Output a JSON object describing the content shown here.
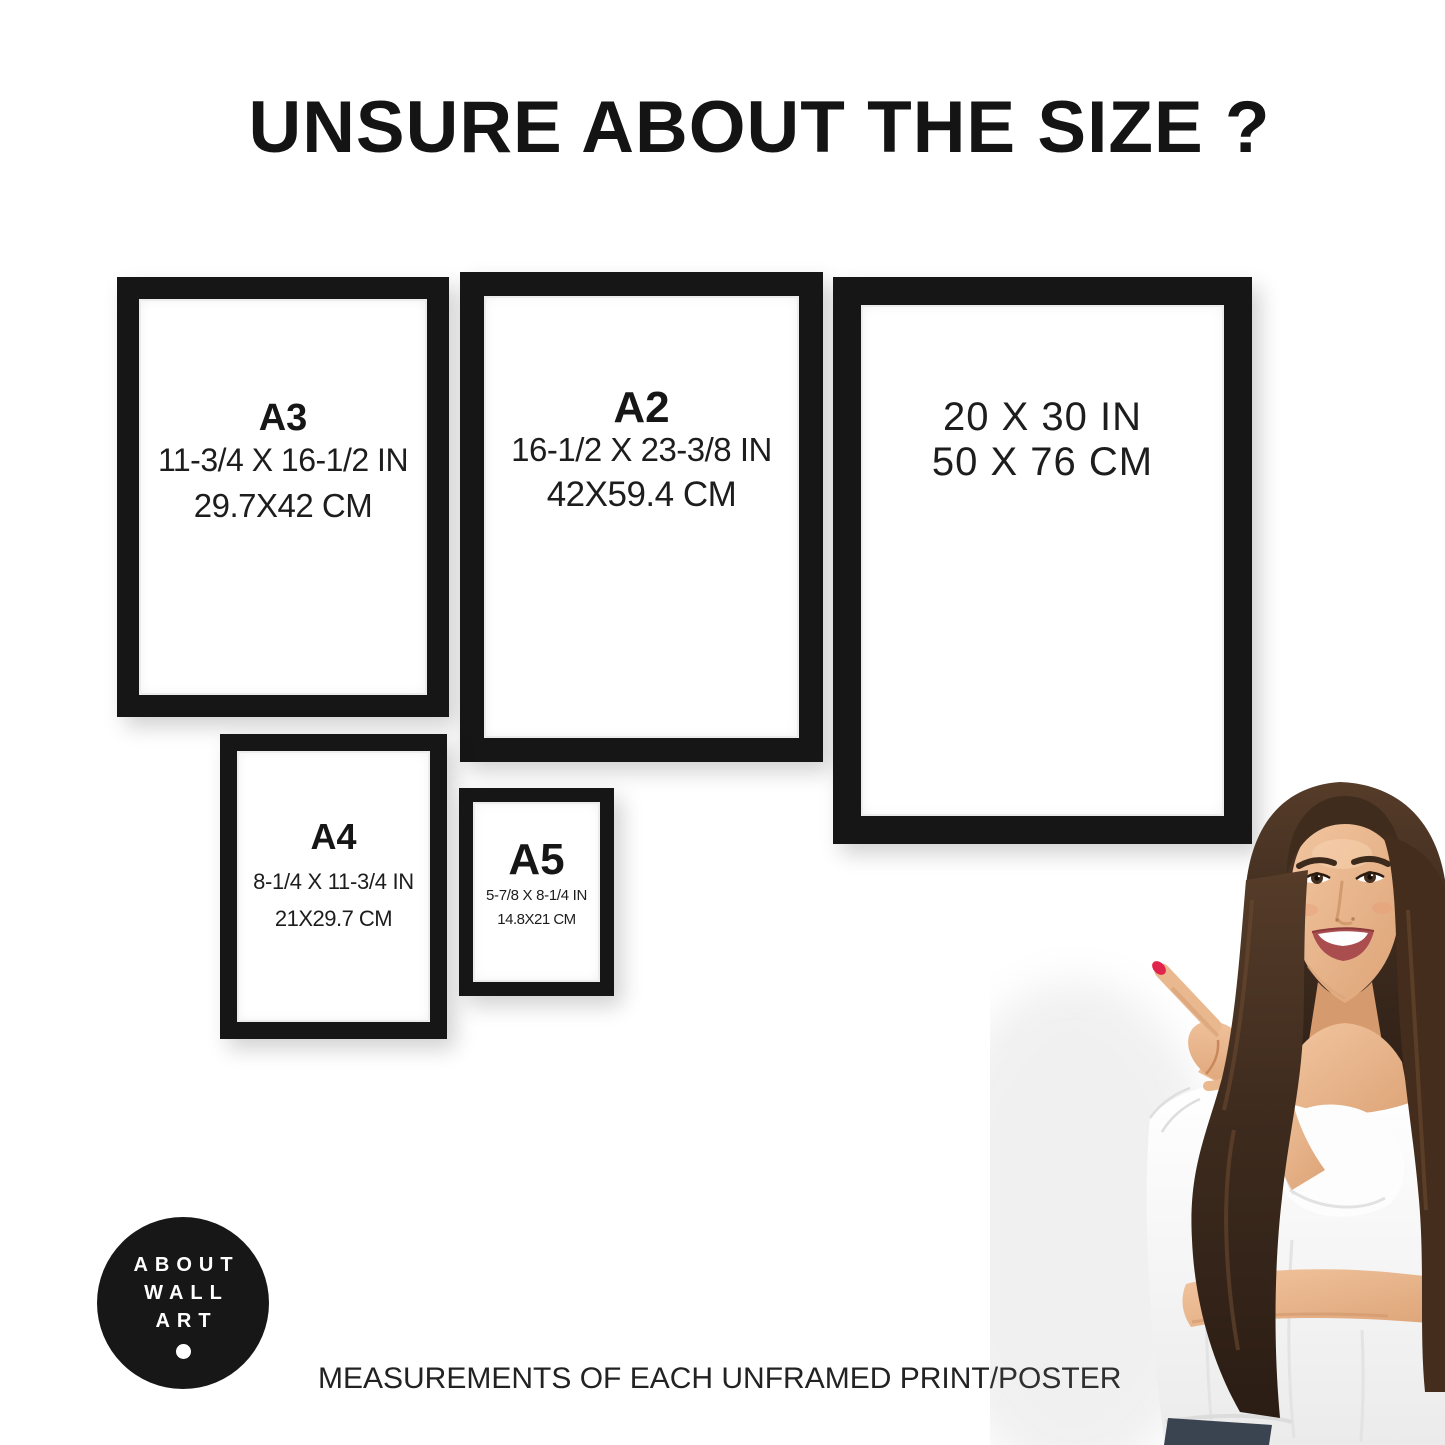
{
  "title": "UNSURE ABOUT THE SIZE ?",
  "caption": "MEASUREMENTS OF EACH UNFRAMED PRINT/POSTER",
  "frames": {
    "a3": {
      "label": "A3",
      "inches": "11-3/4 X 16-1/2 IN",
      "cm": "29.7X42 CM"
    },
    "a2": {
      "label": "A2",
      "inches": "16-1/2 X 23-3/8 IN",
      "cm": "42X59.4 CM"
    },
    "p2030": {
      "inches": "20 X 30 IN",
      "cm": "50 X 76 CM"
    },
    "a4": {
      "label": "A4",
      "inches": "8-1/4 X 11-3/4 IN",
      "cm": "21X29.7 CM"
    },
    "a5": {
      "label": "A5",
      "inches": "5-7/8 X 8-1/4 IN",
      "cm": "14.8X21 CM"
    }
  },
  "logo": {
    "lines": [
      "ABOUT",
      "WALL",
      "ART"
    ]
  },
  "colors": {
    "frame_black": "#161616",
    "text": "#1b1b1b",
    "logo_bg": "#171717",
    "logo_fg": "#ffffff",
    "nail_red": "#e0244d",
    "hair_brown": "#3e2b1e",
    "skin": "#e9b88e",
    "blouse_white": "#fbfbfb"
  }
}
